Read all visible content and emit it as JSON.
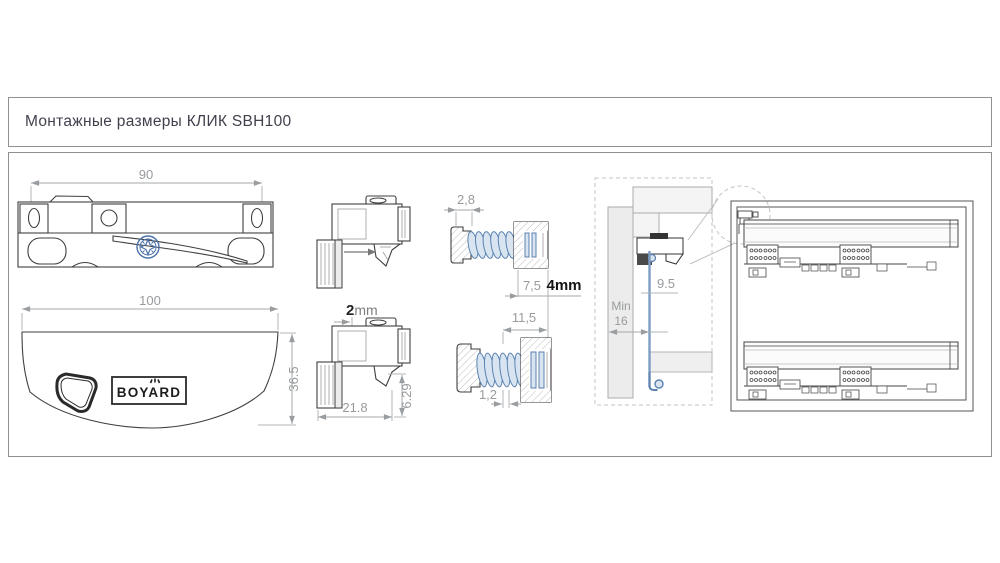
{
  "header": {
    "title": "Монтажные размеры КЛИК SBH100"
  },
  "colors": {
    "accent_blue": "#5b82b0",
    "accent_blue_fill": "#d9e4f1",
    "dimension_gray": "#989b9e",
    "outline_dark": "#3f3f3f",
    "frame_border": "#8f8f8f"
  },
  "latch_top_view": {
    "width_dim": "90",
    "screw_icon": "pozidriv-screw-icon"
  },
  "cover_view": {
    "width_dim": "100",
    "height_dim": "36.5",
    "logo_text": "BOYARD"
  },
  "latch_side_view": {
    "gap_value": "2",
    "gap_unit": "mm",
    "depth_dim": "21.8",
    "height_dim": "6.29"
  },
  "adjuster_upper_view": {
    "tip_dim": "2,8",
    "flange_dim": "7,5",
    "panel_thickness_dim": "4mm"
  },
  "adjuster_lower_view": {
    "body_dim": "11,5",
    "tip_dim": "1,2"
  },
  "mounting_section_view": {
    "offset_dim": "9.5",
    "min_label": "Min",
    "min_value": "16"
  }
}
